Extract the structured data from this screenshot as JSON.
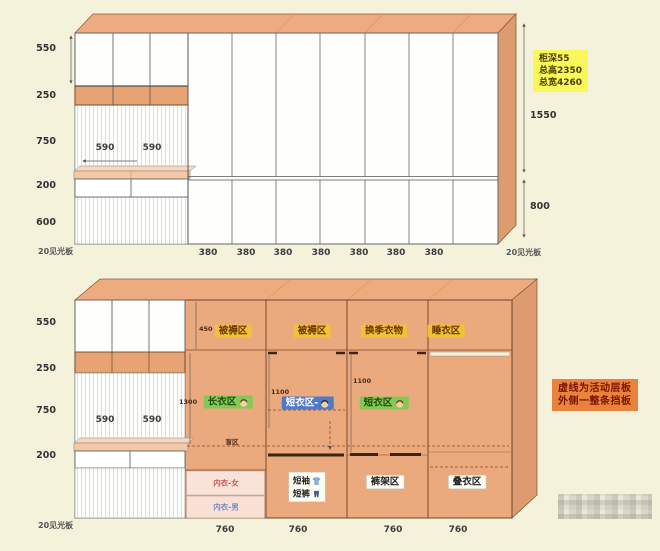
{
  "top_diagram": {
    "left_dims": [
      "550",
      "250",
      "750",
      "200",
      "600"
    ],
    "edge_note_left": "20见光板",
    "edge_note_right": "20见光板",
    "desk_widths": [
      "590",
      "590"
    ],
    "door_widths": [
      "380",
      "380",
      "380",
      "380",
      "380",
      "380",
      "380"
    ],
    "right_dims": [
      "1550",
      "800"
    ],
    "spec_note": {
      "line1": "柜深55",
      "line2": "总高2350",
      "line3": "总宽4260"
    }
  },
  "bottom_diagram": {
    "left_dims": [
      "550",
      "250",
      "750",
      "200"
    ],
    "edge_note_left": "20见光板",
    "desk_widths": [
      "590",
      "590"
    ],
    "column_widths": [
      "760",
      "760",
      "760",
      "760"
    ],
    "top_zones": [
      "被褥区",
      "被褥区",
      "换季衣物",
      "睡衣区"
    ],
    "small_dims": {
      "top_strip": "450",
      "col1": "1300",
      "col2": "1100",
      "col3": "1100"
    },
    "zones": {
      "long_clothes": "长衣区",
      "short_clothes_blue": "短衣区-",
      "short_clothes_green": "短衣区",
      "blind": "盲区",
      "underwear_female": "内衣-女",
      "underwear_male": "内衣-男",
      "short_sleeve": "短袖",
      "shorts": "短裤",
      "trouser_rack": "裤架区",
      "folded_clothes": "叠衣区"
    },
    "note": {
      "line1": "虚线为活动层板",
      "line2": "外侧一整条挡板"
    }
  },
  "colors": {
    "cabinet_orange": "#ebaa7e",
    "cabinet_side": "#de9b6f",
    "countertop": "#f5c8a6",
    "spec_note_bg": "#faf75a",
    "note_bg": "#e8823c",
    "zone_yellow": "#f0c23a",
    "zone_green": "#85c858",
    "zone_blue": "#4f79c9",
    "underwear_box": "#f9e3d9",
    "background": "#f4f2db"
  }
}
